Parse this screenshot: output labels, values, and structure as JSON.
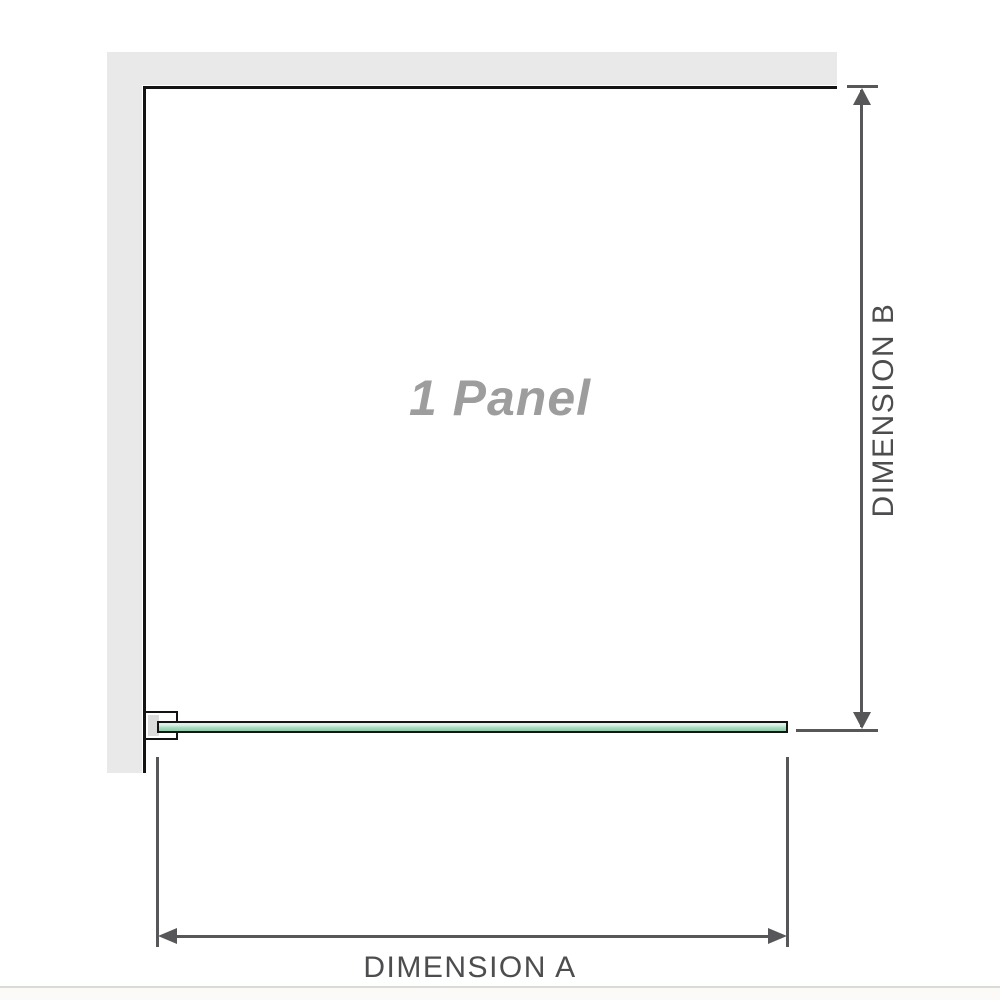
{
  "diagram": {
    "panel_label": "1 Panel",
    "dimension_a_label": "DIMENSION A",
    "dimension_b_label": "DIMENSION B"
  },
  "colors": {
    "background": "#ffffff",
    "wall": "#e9e9e9",
    "outline": "#141414",
    "dimension": "#57575a",
    "label_text": "#4d4d4f",
    "panel_label_text": "#9d9d9d",
    "glass_light": "#ddf2e6",
    "glass_mid": "#a9dcc0",
    "glass_dark": "#8fcbaa",
    "bracket_shim": "#dcdcdc",
    "separator": "#d9dcd5",
    "footer_bg": "#fbfaf8"
  }
}
